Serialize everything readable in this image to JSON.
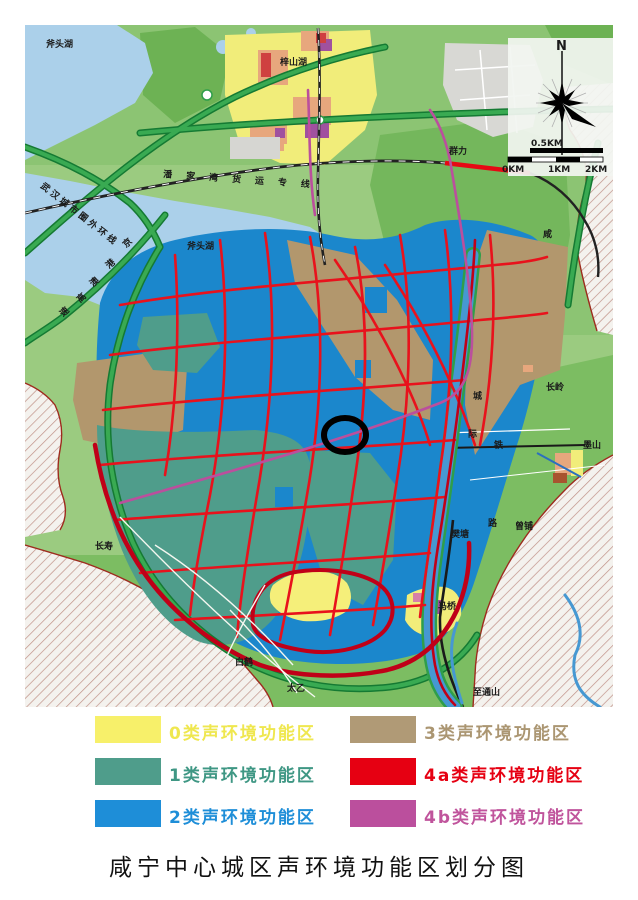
{
  "title": "咸宁中心城区声环境功能区划分图",
  "legend": {
    "items": [
      {
        "label": "0类声环境功能区",
        "color": "#f7f06a",
        "text_color": "#efe74f"
      },
      {
        "label": "1类声环境功能区",
        "color": "#4f9d8b",
        "text_color": "#3f9784"
      },
      {
        "label": "2类声环境功能区",
        "color": "#1e8ed8",
        "text_color": "#1e8ed8"
      },
      {
        "label": "3类声环境功能区",
        "color": "#b09a76",
        "text_color": "#ab9672"
      },
      {
        "label": "4a类声环境功能区",
        "color": "#e60012",
        "text_color": "#e60012"
      },
      {
        "label": "4b类声环境功能区",
        "color": "#bb4f9d",
        "text_color": "#c0549c"
      }
    ]
  },
  "compass": {
    "north": "N",
    "scale_label": "0.5KM",
    "ticks": [
      "0KM",
      "1KM",
      "2KM"
    ]
  },
  "map": {
    "labels": [
      {
        "name": "futou-lake-nw",
        "text": "斧头湖"
      },
      {
        "name": "zishan-lake",
        "text": "梓山湖"
      },
      {
        "name": "qunli",
        "text": "群力"
      },
      {
        "name": "futou-lake-center",
        "text": "斧头湖"
      },
      {
        "name": "changling",
        "text": "长岭"
      },
      {
        "name": "moshan",
        "text": "墨山"
      },
      {
        "name": "zengpu",
        "text": "曾铺"
      },
      {
        "name": "fantang",
        "text": "樊塘"
      },
      {
        "name": "maqiao",
        "text": "马桥"
      },
      {
        "name": "changshou",
        "text": "长寿"
      },
      {
        "name": "baihe",
        "text": "白鹤"
      },
      {
        "name": "taiyi",
        "text": "太乙"
      },
      {
        "name": "zhitongshan",
        "text": "至通山"
      }
    ],
    "road_labels": [
      {
        "name": "wuhan-outer-ring",
        "text": "武汉城市圈外环线"
      },
      {
        "name": "panjiawan-freight",
        "text": "潘家湾货运专线"
      }
    ],
    "railway_label": [
      "咸",
      "城",
      "际",
      "铁",
      "路"
    ],
    "expressway_label": [
      "京",
      "港",
      "澳",
      "高",
      "速"
    ]
  },
  "colors": {
    "zone0_yellow": "#f5ef7a",
    "zone1_teal": "#4f9d8b",
    "zone2_blue": "#1b87cc",
    "zone3_tan": "#b2976d",
    "zone4a_red": "#e60914",
    "zone4b_magenta": "#bb4f9d",
    "water": "#abd0ea",
    "land": "#9bcb80",
    "forest": "#6db254",
    "green_road": "#39aa52",
    "boundary_red": "#9e2b1e"
  }
}
